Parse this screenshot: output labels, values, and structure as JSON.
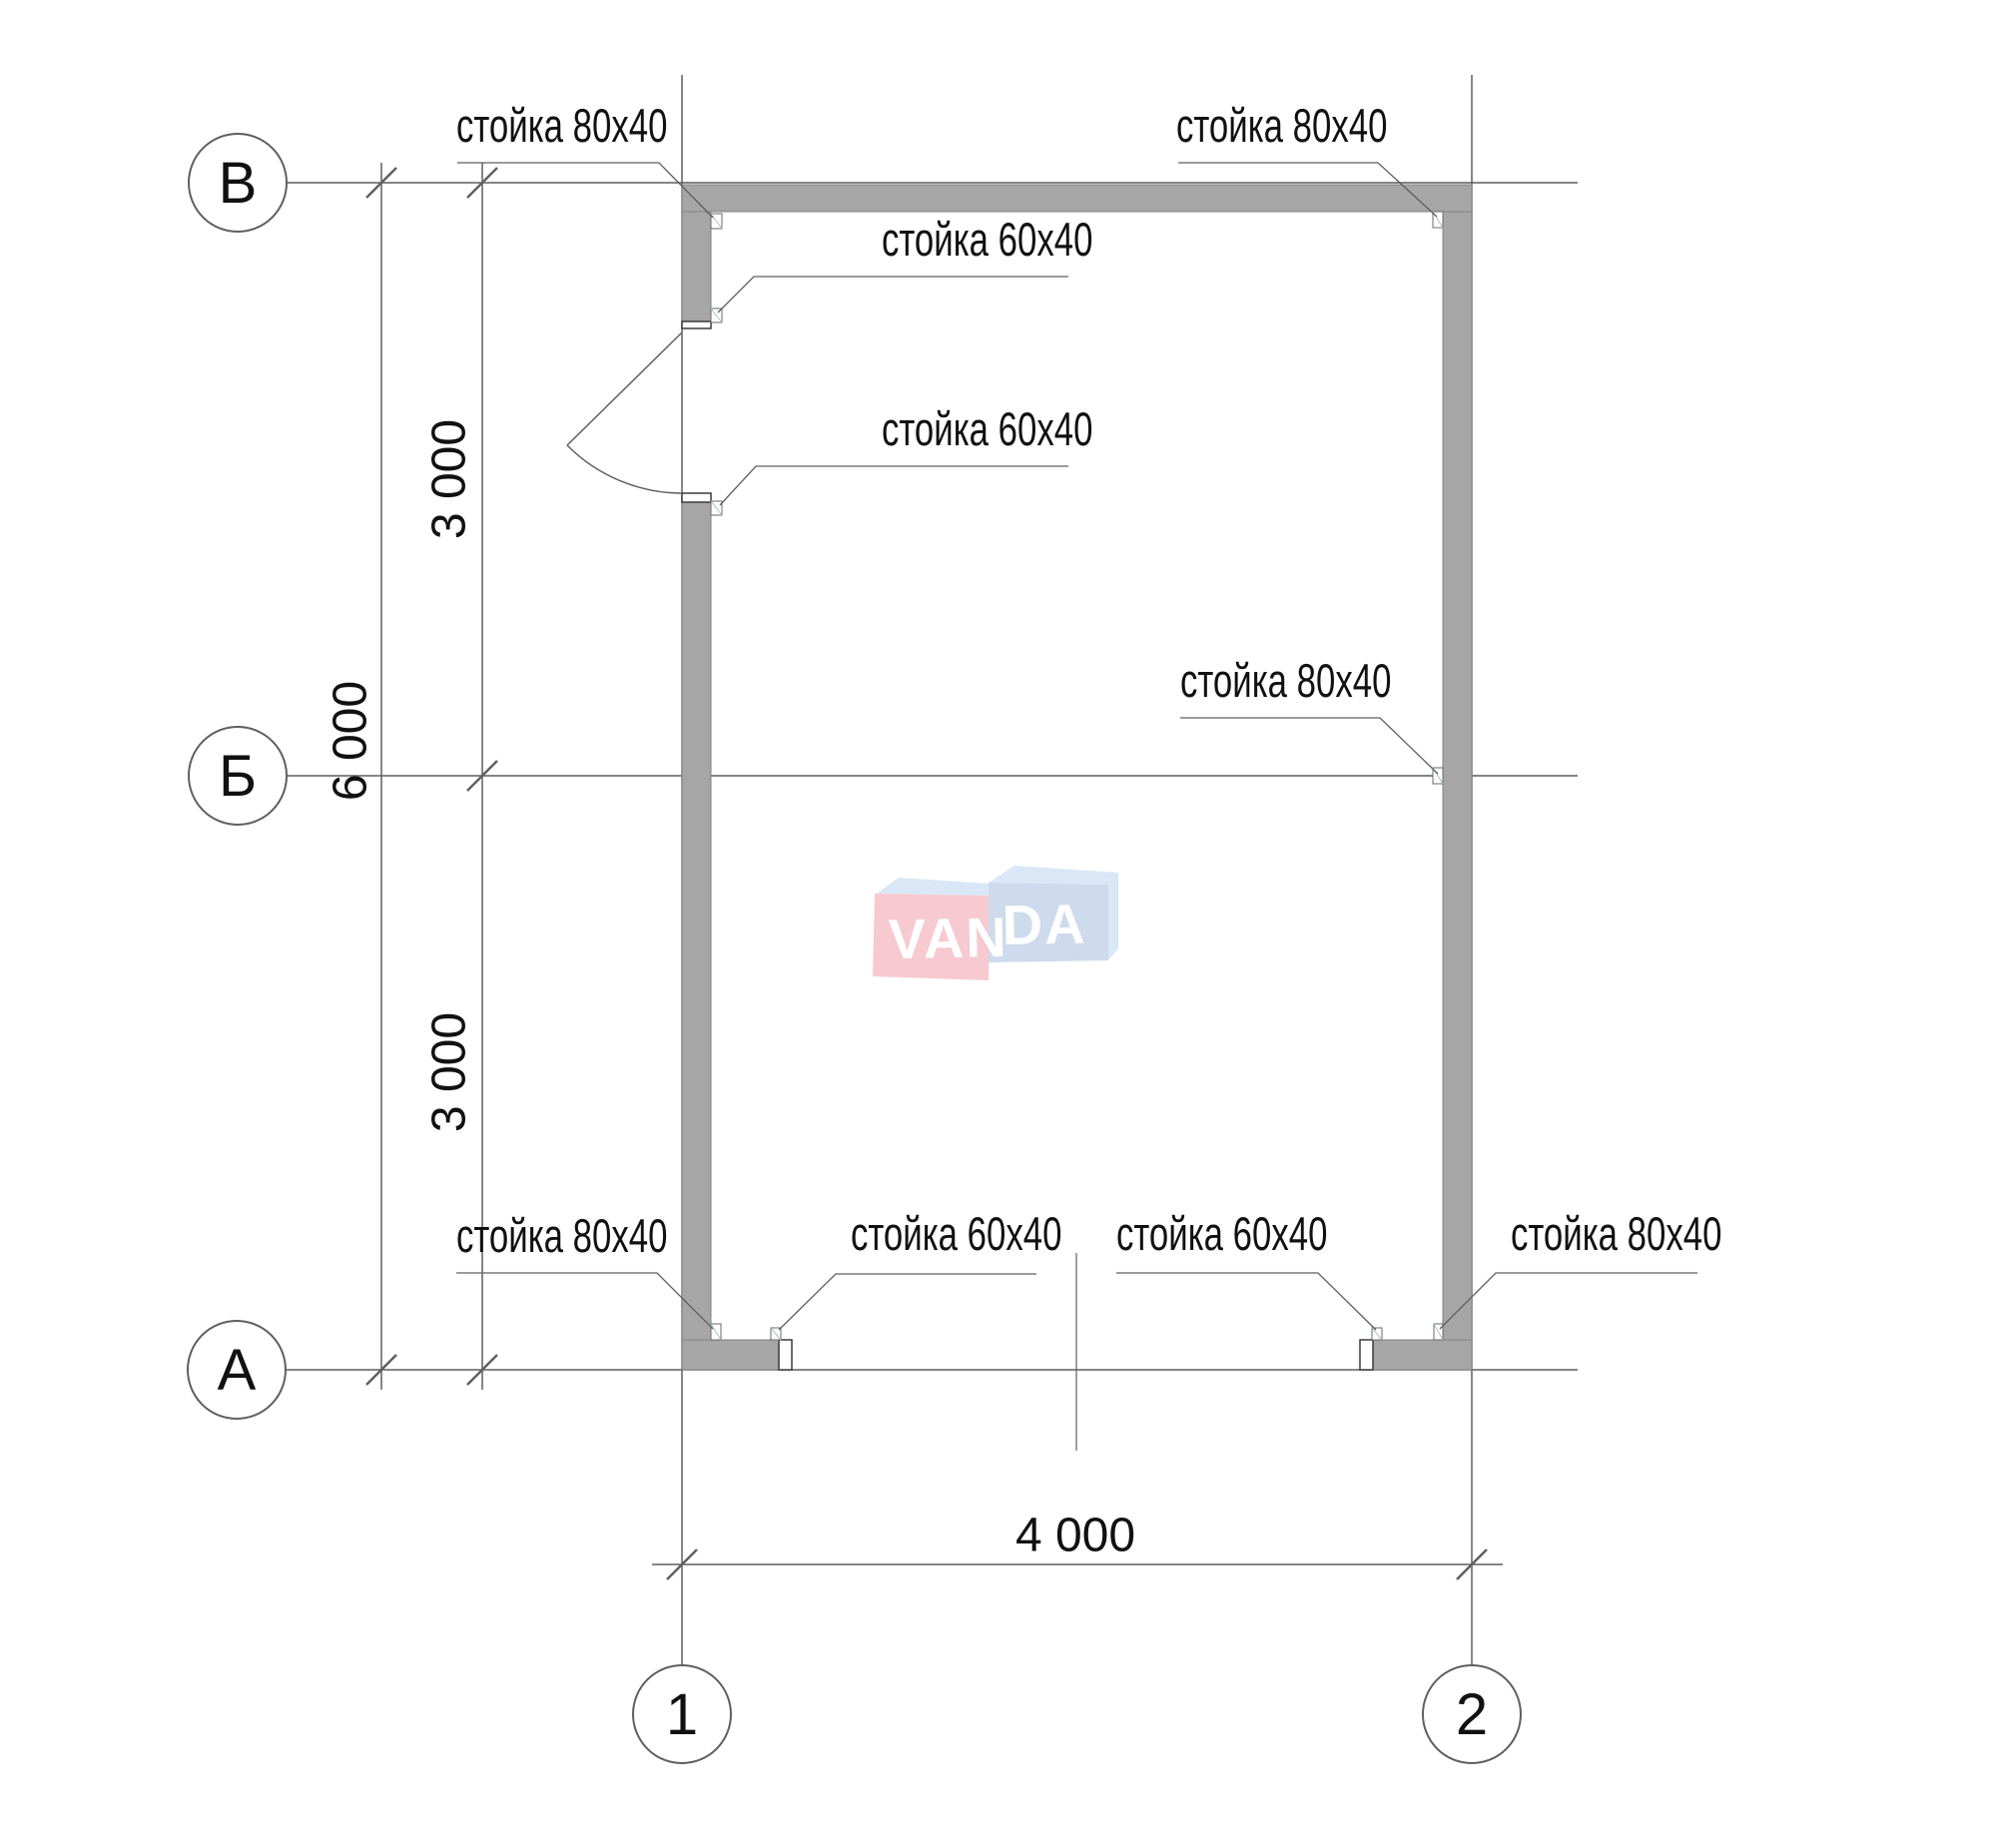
{
  "axes": {
    "rows": [
      {
        "label": "В"
      },
      {
        "label": "Б"
      },
      {
        "label": "А"
      }
    ],
    "cols": [
      {
        "label": "1"
      },
      {
        "label": "2"
      }
    ]
  },
  "dimensions": {
    "upper_left": "3 000",
    "overall_left": "6 000",
    "lower_left": "3 000",
    "bottom": "4 000"
  },
  "stud_labels": [
    {
      "id": "top-left",
      "text": "стойка 80х40"
    },
    {
      "id": "top-right",
      "text": "стойка 80х40"
    },
    {
      "id": "door-top",
      "text": "стойка 60х40"
    },
    {
      "id": "door-bottom",
      "text": "стойка 60х40"
    },
    {
      "id": "mid-right",
      "text": "стойка 80х40"
    },
    {
      "id": "bottom-left",
      "text": "стойка 80х40"
    },
    {
      "id": "bottom-opening-left",
      "text": "стойка 60х40"
    },
    {
      "id": "bottom-opening-right",
      "text": "стойка 60х40"
    },
    {
      "id": "bottom-right",
      "text": "стойка 80х40"
    }
  ],
  "watermark": {
    "part1": "VAN",
    "part2": "DA"
  },
  "colors": {
    "wall_fill": "#a6a6a6",
    "wall_edge": "#838383",
    "line": "#5f5f5f",
    "text": "#111111",
    "watermark_pink": "#f6cad0",
    "watermark_blue": "#cddbec",
    "watermark_light": "#d9e7f6"
  }
}
